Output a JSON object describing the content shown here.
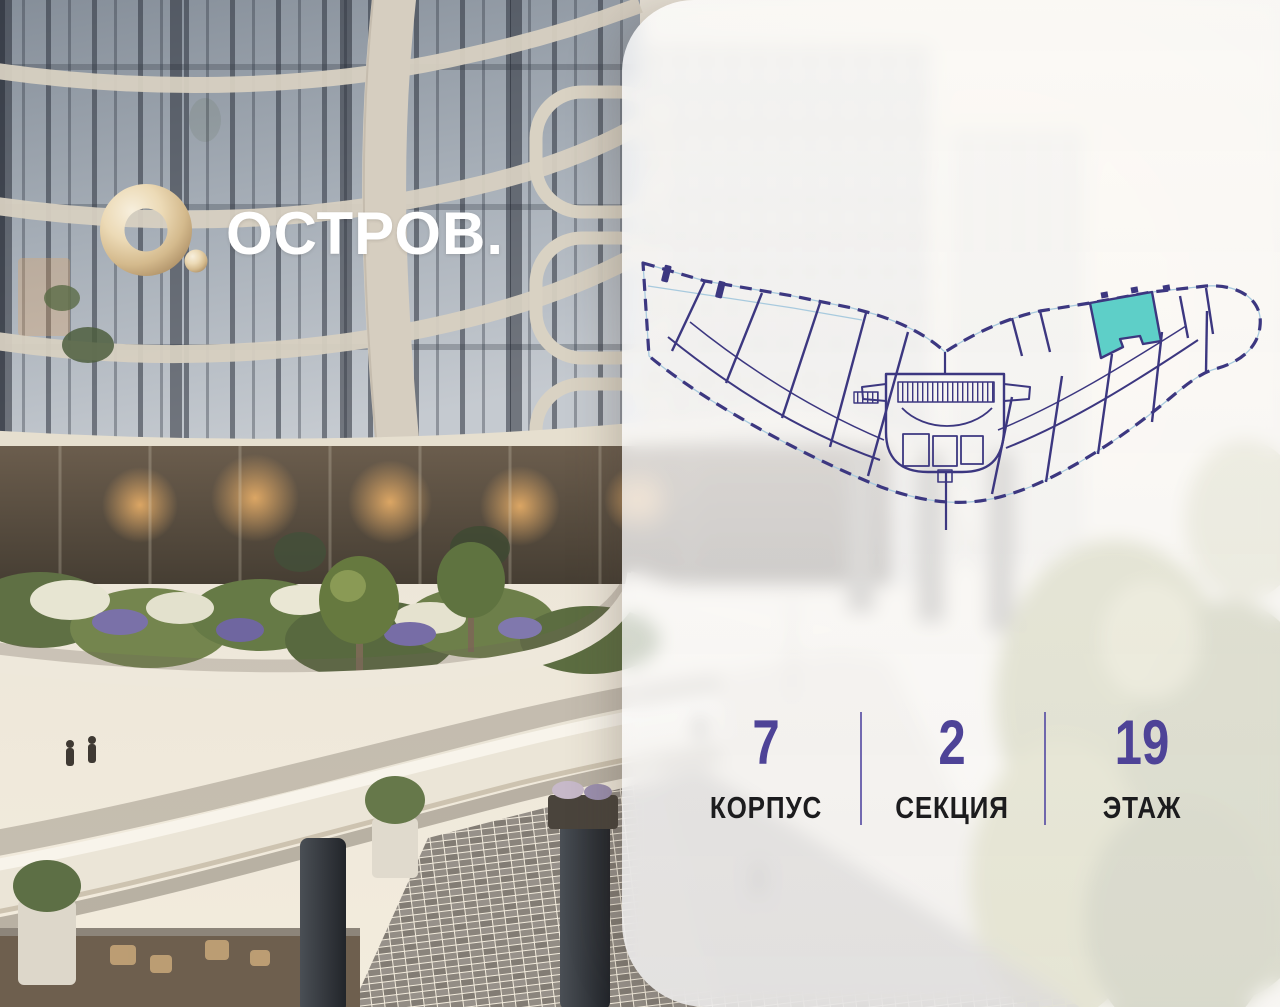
{
  "brand": {
    "wordmark": "ОСТРОВ."
  },
  "floor_plan": {
    "line_color": "#3c3780",
    "accent_line_color": "#a8cade",
    "highlight_color": "#5ecfc8"
  },
  "stats": {
    "value_color": "#4e4397",
    "items": [
      {
        "value": "7",
        "label": "КОРПУС"
      },
      {
        "value": "2",
        "label": "СЕКЦИЯ"
      },
      {
        "value": "19",
        "label": "ЭТАЖ"
      }
    ]
  }
}
